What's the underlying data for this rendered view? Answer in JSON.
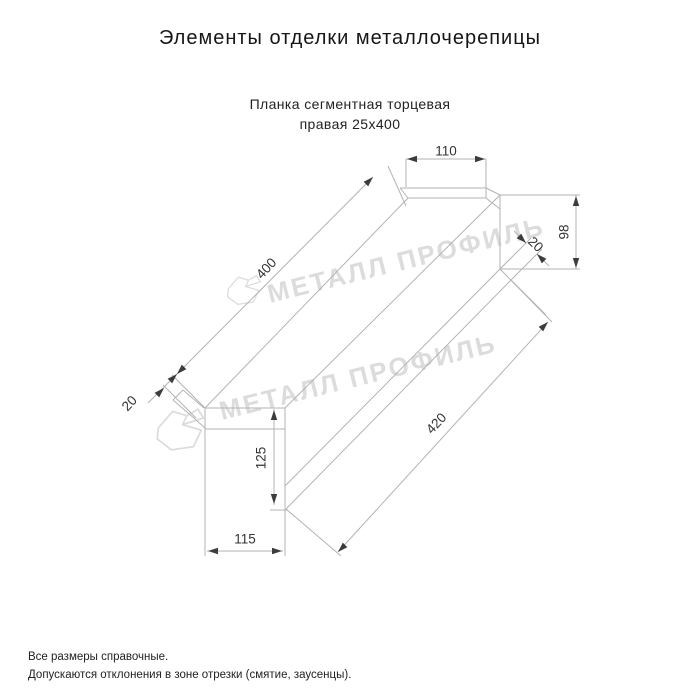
{
  "page": {
    "title": "Элементы отделки металлочерепицы",
    "subtitle_line1": "Планка сегментная торцевая",
    "subtitle_line2": "правая 25х400",
    "background": "#ffffff"
  },
  "notes": {
    "line1": "Все размеры справочные.",
    "line2": "Допускаются отклонения в зоне отрезки (смятие, заусенцы)."
  },
  "watermark": {
    "text": "МЕТАЛЛ ПРОФИЛЬ",
    "color": "#dcdcdc",
    "font_size": 26,
    "instances": [
      {
        "x": 270,
        "y": 303,
        "rotate": -14
      },
      {
        "x": 222,
        "y": 420,
        "rotate": -14
      }
    ],
    "logo_path": "M3,19 L16,4 L29,8 L25,16 L42,21 L35,36 L15,39 L2,29 Z M29,8 L39,2 L44,10 L25,16 Z",
    "logos": [
      {
        "x": 226,
        "y": 274,
        "scale": 0.78
      },
      {
        "x": 155,
        "y": 407,
        "scale": 1.1
      }
    ]
  },
  "drawing": {
    "canvas": {
      "width": 700,
      "height": 700
    },
    "line_color": "#b3b3b3",
    "dim_line_color": "#b3b3b3",
    "arrow_color": "#3c3c3c",
    "label_color": "#333333",
    "label_font_size": 13.5,
    "part_lines": [
      [
        205,
        408,
        285,
        408
      ],
      [
        206,
        429,
        285,
        429
      ],
      [
        205,
        408,
        205,
        556
      ],
      [
        285,
        408,
        285,
        510
      ],
      [
        285,
        510,
        285,
        556
      ],
      [
        205,
        408,
        408,
        198
      ],
      [
        285,
        408,
        500,
        195
      ],
      [
        285,
        486,
        500,
        269
      ],
      [
        286,
        509,
        511,
        280
      ],
      [
        408,
        198,
        486,
        198
      ],
      [
        400,
        188,
        486,
        188
      ],
      [
        408,
        198,
        400,
        188
      ],
      [
        486,
        188,
        500,
        195
      ],
      [
        486,
        198,
        500,
        209
      ],
      [
        500,
        195,
        500,
        269
      ],
      [
        500,
        269,
        552,
        322
      ],
      [
        511,
        280,
        546,
        315
      ],
      [
        286,
        509,
        341,
        556
      ],
      [
        204,
        408,
        183,
        390
      ],
      [
        183,
        390,
        173,
        400
      ],
      [
        173,
        400,
        195,
        419
      ],
      [
        195,
        419,
        206,
        429
      ]
    ],
    "ext_lines": [
      [
        406,
        159,
        406,
        187
      ],
      [
        486,
        159,
        486,
        198
      ],
      [
        500,
        195,
        580,
        195
      ],
      [
        500,
        269,
        580,
        269
      ],
      [
        205,
        408,
        172,
        375
      ],
      [
        196,
        418,
        163,
        385
      ],
      [
        406,
        206,
        388,
        166
      ],
      [
        500,
        269,
        531,
        238
      ],
      [
        511,
        280,
        542,
        249
      ],
      [
        270,
        510,
        288,
        510
      ]
    ],
    "dim_lines": [
      [
        406,
        159,
        486,
        159
      ],
      [
        177,
        374,
        373,
        177
      ],
      [
        148,
        403,
        178,
        373
      ],
      [
        576,
        195,
        576,
        269
      ],
      [
        514,
        231,
        526,
        243
      ],
      [
        537,
        254,
        549,
        266
      ],
      [
        338,
        552,
        548,
        322
      ],
      [
        274,
        409,
        274,
        505
      ],
      [
        207,
        551,
        283,
        551
      ]
    ],
    "arrows": [
      {
        "x": 407,
        "y": 159,
        "angle": 180
      },
      {
        "x": 485,
        "y": 159,
        "angle": 0
      },
      {
        "x": 373,
        "y": 177,
        "angle": -45
      },
      {
        "x": 177,
        "y": 374,
        "angle": 135
      },
      {
        "x": 177,
        "y": 374,
        "angle": -45
      },
      {
        "x": 164,
        "y": 388,
        "angle": -45
      },
      {
        "x": 576,
        "y": 196,
        "angle": -90
      },
      {
        "x": 576,
        "y": 268,
        "angle": 90
      },
      {
        "x": 526,
        "y": 243,
        "angle": 45
      },
      {
        "x": 537,
        "y": 254,
        "angle": -135
      },
      {
        "x": 338,
        "y": 552,
        "angle": 135
      },
      {
        "x": 548,
        "y": 322,
        "angle": -45
      },
      {
        "x": 274,
        "y": 410,
        "angle": -90
      },
      {
        "x": 274,
        "y": 504,
        "angle": 90
      },
      {
        "x": 208,
        "y": 551,
        "angle": 180
      },
      {
        "x": 282,
        "y": 551,
        "angle": 0
      }
    ],
    "labels": [
      {
        "text": "110",
        "x": 446,
        "y": 152,
        "rotate": 0
      },
      {
        "text": "400",
        "x": 267,
        "y": 269,
        "rotate": -47
      },
      {
        "text": "20",
        "x": 130,
        "y": 404,
        "rotate": -47
      },
      {
        "text": "98",
        "x": 565,
        "y": 232,
        "rotate": -90
      },
      {
        "text": "20",
        "x": 535,
        "y": 245,
        "rotate": 44
      },
      {
        "text": "420",
        "x": 437,
        "y": 424,
        "rotate": -47
      },
      {
        "text": "125",
        "x": 262,
        "y": 458,
        "rotate": -90
      },
      {
        "text": "115",
        "x": 245,
        "y": 540,
        "rotate": 0
      }
    ]
  }
}
